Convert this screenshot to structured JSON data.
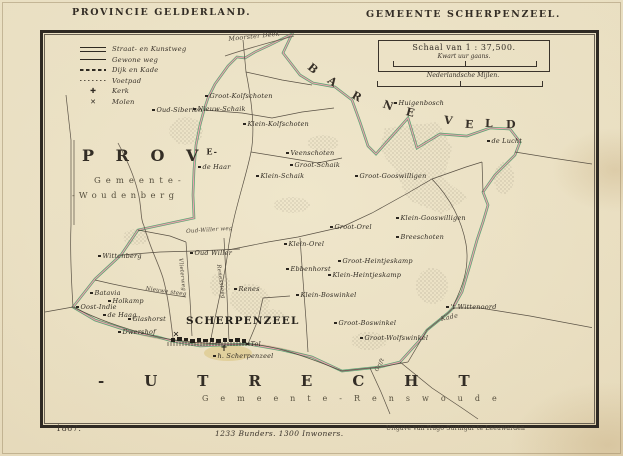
{
  "page": {
    "title_left": "PROVINCIE GELDERLAND.",
    "title_right": "GEMEENTE SCHERPENZEEL."
  },
  "legend": {
    "items": [
      {
        "symbol": "double-line",
        "label": "Straat- en Kunstweg"
      },
      {
        "symbol": "single-line",
        "label": "Gewone weg"
      },
      {
        "symbol": "dashed-line",
        "label": "Dijk en Kade"
      },
      {
        "symbol": "dotted-line",
        "label": "Voetpad"
      },
      {
        "symbol": "cross",
        "glyph": "✚",
        "label": "Kerk"
      },
      {
        "symbol": "mill",
        "glyph": "✕",
        "label": "Molen"
      }
    ]
  },
  "scale": {
    "title": "Schaal van 1 : 37,500.",
    "walk_label": "Kwart uur gaans.",
    "miles_label": "Nederlandsche Mijlen."
  },
  "regions": {
    "north": "BARNEVELD",
    "province_abbr": "P R O V",
    "province_sup": "E",
    "province_dash": "-",
    "west_line1": "Gemeente-",
    "west_line2": "-Woudenberg",
    "south": "-UTRECHT",
    "south_gemeente": "Gemeente-Renswoude",
    "town": "SCHERPENZEEL"
  },
  "footer": {
    "year": "1867.",
    "stats": "1233 Bunders. 1300 Inwoners.",
    "publisher": "Uitgave van Hugo Suringar te Leeuwarden"
  },
  "colors": {
    "paper": "#e9dfc2",
    "frame": "#2f2a23",
    "boundary_green": "#4c9f6d",
    "boundary_pink": "#ef9fae",
    "road": "#4a4237",
    "stream": "#6a6052",
    "village_tint": "#d8c27c",
    "text": "#2f2a22"
  },
  "map_labels": [
    {
      "t": "Oud-Siberien",
      "x": 152,
      "y": 106
    },
    {
      "t": "Groot-Kolfschoten",
      "x": 205,
      "y": 92
    },
    {
      "t": "Nieuw-Schaik",
      "x": 193,
      "y": 105
    },
    {
      "t": "Klein-Kolfschoten",
      "x": 243,
      "y": 120
    },
    {
      "t": "Huigenbosch",
      "x": 394,
      "y": 99
    },
    {
      "t": "de Lucht",
      "x": 487,
      "y": 137
    },
    {
      "t": "de Haar",
      "x": 198,
      "y": 163
    },
    {
      "t": "Veenschoten",
      "x": 286,
      "y": 149
    },
    {
      "t": "Groot-Schaik",
      "x": 290,
      "y": 161
    },
    {
      "t": "Klein-Schaik",
      "x": 256,
      "y": 172
    },
    {
      "t": "Groot-Gooswilligen",
      "x": 355,
      "y": 172
    },
    {
      "t": "Klein-Gooswilligen",
      "x": 396,
      "y": 214
    },
    {
      "t": "Breeschoten",
      "x": 396,
      "y": 233
    },
    {
      "t": "Groot-Orel",
      "x": 330,
      "y": 223
    },
    {
      "t": "Klein-Orel",
      "x": 284,
      "y": 240
    },
    {
      "t": "Ebbenhorst",
      "x": 286,
      "y": 265
    },
    {
      "t": "Groot-Heintjeskamp",
      "x": 338,
      "y": 257
    },
    {
      "t": "Klein-Heintjeskamp",
      "x": 328,
      "y": 271
    },
    {
      "t": "Klein-Boswinkel",
      "x": 296,
      "y": 291
    },
    {
      "t": "Groot-Boswinkel",
      "x": 334,
      "y": 319
    },
    {
      "t": "Groot-Wolfswinkel",
      "x": 360,
      "y": 334
    },
    {
      "t": "'t Wittenoord",
      "x": 446,
      "y": 303
    },
    {
      "t": "Wittenberg",
      "x": 98,
      "y": 252
    },
    {
      "t": "Oud Willer",
      "x": 190,
      "y": 249
    },
    {
      "t": "Batavia",
      "x": 90,
      "y": 289
    },
    {
      "t": "Holkamp",
      "x": 108,
      "y": 297
    },
    {
      "t": "Oost-Indie",
      "x": 76,
      "y": 303
    },
    {
      "t": "de Haag",
      "x": 103,
      "y": 311
    },
    {
      "t": "Glashorst",
      "x": 128,
      "y": 315
    },
    {
      "t": "Dwershof",
      "x": 118,
      "y": 328
    },
    {
      "t": "Renes",
      "x": 234,
      "y": 285
    },
    {
      "t": "h. Scherpenzeel",
      "x": 213,
      "y": 352
    },
    {
      "t": "Tol",
      "x": 246,
      "y": 340
    },
    {
      "t": "Moorster Beek",
      "x": 228,
      "y": 35,
      "s": "water",
      "r": -6
    },
    {
      "t": "Kade",
      "x": 440,
      "y": 315,
      "s": "water",
      "r": -12
    },
    {
      "t": "Oud-Willer weg",
      "x": 186,
      "y": 229,
      "s": "road",
      "r": -4
    },
    {
      "t": "Vlieterweg",
      "x": 183,
      "y": 258,
      "s": "road",
      "r": 84
    },
    {
      "t": "Renessteeg",
      "x": 221,
      "y": 264,
      "s": "road",
      "r": 82
    },
    {
      "t": "Nieuwe steeg",
      "x": 146,
      "y": 286,
      "s": "road",
      "r": 8
    },
    {
      "t": "Grift",
      "x": 374,
      "y": 370,
      "s": "road",
      "r": -62
    }
  ],
  "north_letter_positions": [
    [
      308,
      62,
      40
    ],
    [
      328,
      75,
      36
    ],
    [
      352,
      90,
      30
    ],
    [
      383,
      99,
      20
    ],
    [
      406,
      106,
      14
    ],
    [
      444,
      114,
      8
    ],
    [
      465,
      118,
      4
    ],
    [
      485,
      117,
      2
    ],
    [
      506,
      118,
      0
    ]
  ]
}
